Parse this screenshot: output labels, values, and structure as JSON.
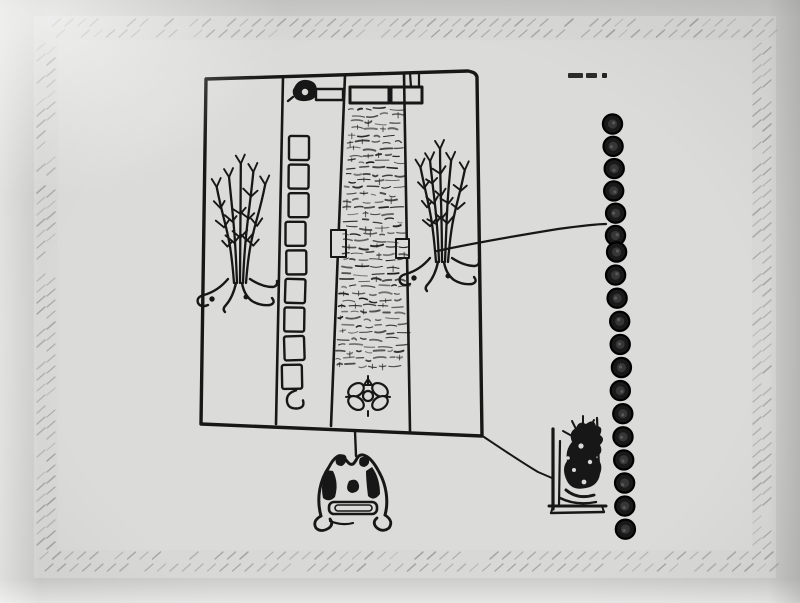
{
  "photo": {
    "description": "black-and-white photograph of a hand-drawn codex facsimile plate",
    "colors": {
      "photo_background": "#cdcdcb",
      "page": "#d8d8d6",
      "page_inner": "#dbdbd9",
      "ink": "#171717",
      "border_hatch": "#9e9e9c"
    }
  },
  "plate": {
    "caption": {
      "legible": false,
      "marks": 3
    },
    "border": {
      "style": "diagonal-stitch-hatch",
      "sides": 4
    },
    "panel": {
      "left_plant": "plant with five stems, leaf twigs and exposed roots",
      "box_ladder": {
        "box_count": 9,
        "has_end_hook": true
      },
      "manuscript_text": {
        "legible": false,
        "rows": 40
      },
      "right_plant": "plant with five stems, leaf twigs and exposed roots",
      "top_glyphs": [
        "round-curl-glyph",
        "small-bar",
        "wide-bar",
        "hanging-bar"
      ],
      "bottom_rosette": {
        "petals": 4
      }
    },
    "tally_circles": {
      "top_group": 6,
      "bottom_group": 13,
      "total": 19
    },
    "hill_glyph": {
      "has_band": true,
      "foot_volutes": 2
    },
    "seated_figure": {
      "pose": "person on high-backed seat, facing left"
    },
    "connector_lines": 2
  }
}
